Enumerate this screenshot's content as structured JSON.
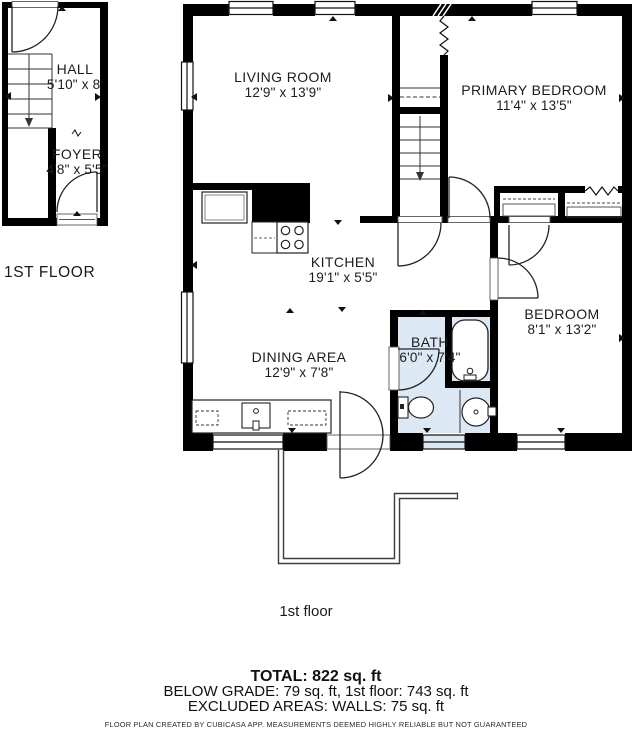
{
  "plan": {
    "small_unit_floor_label": "1ST FLOOR",
    "rooms": {
      "hall": {
        "name": "HALL",
        "dims": "5'10\" x 8'"
      },
      "foyer": {
        "name": "FOYER",
        "dims": "4'8\" x 5'5\""
      },
      "living_room": {
        "name": "LIVING ROOM",
        "dims": "12'9\" x 13'9\""
      },
      "primary_bedroom": {
        "name": "PRIMARY BEDROOM",
        "dims": "11'4\" x 13'5\""
      },
      "kitchen": {
        "name": "KITCHEN",
        "dims": "19'1\" x 5'5\""
      },
      "dining_area": {
        "name": "DINING AREA",
        "dims": "12'9\" x 7'8\""
      },
      "bath": {
        "name": "BATH",
        "dims": "6'0\" x 7'4\""
      },
      "bedroom": {
        "name": "BEDROOM",
        "dims": "8'1\" x 13'2\""
      }
    }
  },
  "footer": {
    "floor_caption": "1st floor",
    "total": "TOTAL: 822 sq. ft",
    "breakdown": "BELOW GRADE: 79 sq. ft, 1st floor: 743 sq. ft",
    "excluded": "EXCLUDED AREAS: WALLS: 75 sq. ft",
    "disclaimer": "FLOOR PLAN CREATED BY CUBICASA APP. MEASUREMENTS DEEMED HIGHLY RELIABLE BUT NOT GUARANTEED"
  },
  "colors": {
    "wall": "#000000",
    "bath_floor": "#dce9f5",
    "line": "#222222"
  }
}
